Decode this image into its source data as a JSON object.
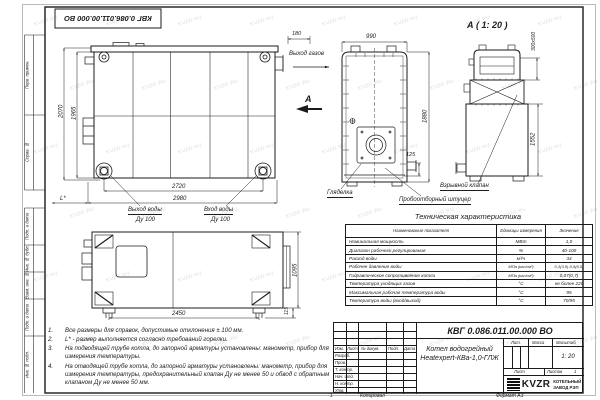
{
  "watermark": "KVZR.RU",
  "frame": {
    "stamp_top": "КВГ 0.086.011.00.000 ВО",
    "margin_labels": [
      "Перв. примен.",
      "Справ. №",
      "Подп. и дата",
      "Инв. № дубл.",
      "Взам. инв. №",
      "Подп. и дата",
      "Инв. № подл."
    ],
    "footer_sheet_num": "1",
    "footer_copy": "Копировал",
    "footer_format": "Формат А3"
  },
  "side_view": {
    "dim_h_outer": "2070",
    "dim_h_inner": "1965",
    "dim_w_inner": "2720",
    "dim_w_outer": "2980",
    "dim_l": "L*",
    "label_water_out": "Выход воды",
    "label_water_out_dn": "Ду 100",
    "label_water_in": "Вход воды",
    "label_water_in_dn": "Ду 100"
  },
  "front_view": {
    "dim_offset": "180",
    "dim_width": "990",
    "dim_height": "1880",
    "dim_pipe": "125",
    "label_gas_out": "Выход газов",
    "label_view": "А",
    "label_sight": "Гляделка",
    "label_sampler": "Пробоотборный штуцер"
  },
  "detail_view": {
    "title": "А ( 1: 20 )",
    "dim_valve": "300х500",
    "dim_height": "1552",
    "label_valve": "Взрывной клапан"
  },
  "top_view": {
    "dim_width": "2450",
    "dim_depth": "1095",
    "dim_foot": "115"
  },
  "notes": [
    {
      "num": "1.",
      "text": "Все размеры для справок, допустимые отклонения ± 100 мм."
    },
    {
      "num": "2.",
      "text": "L* - размер выполняется согласно требований горелки."
    },
    {
      "num": "3.",
      "text": "На подводящей трубе котла, до запорной арматуры установлены: манометр, прибор для измерения температуры."
    },
    {
      "num": "4.",
      "text": "На отводящей трубе котла, до запорной арматуры установлены: манометр, прибор для измерения температуры, предохранительный клапан Ду не менее 50 и обвод с обратным клапаном Ду не менее 50 мм."
    }
  ],
  "tech_table": {
    "title": "Техническая характеристика",
    "headers": {
      "name": "Наименование показателя",
      "units": "Единицы измерения",
      "value": "Значение"
    },
    "rows": [
      {
        "name": "Номинальная мощность",
        "units": "МВт",
        "value": "1,0"
      },
      {
        "name": "Диапазон рабочего регулирования",
        "units": "%",
        "value": "40-100"
      },
      {
        "name": "Расход воды",
        "units": "м³/ч",
        "value": "34"
      },
      {
        "name": "Рабочее давление воды",
        "units": "МПа (кгс/см²)",
        "value": "0,3(3,0)-0,6(6,0)"
      },
      {
        "name": "Гидравлическое сопротивление котла",
        "units": "МПа (кгс/см²)",
        "value": "0,07(0,7)"
      },
      {
        "name": "Температура уходящих газов",
        "units": "°С",
        "value": "не более 220"
      },
      {
        "name": "Максимальная рабочая температура воды",
        "units": "°С",
        "value": "95"
      },
      {
        "name": "Температура воды (вход/выход)",
        "units": "°С",
        "value": "70/95"
      }
    ]
  },
  "title_block": {
    "doc_number": "КВГ 0.086.011.00.000 ВО",
    "name_line1": "Котел водогрейный",
    "name_line2": "Heatexpert-КВа-1,0-ГЛЖ",
    "col_izm": "Изм.",
    "col_list": "Лист",
    "col_doc": "№ докум.",
    "col_podp": "Подп.",
    "col_data": "Дата",
    "roles": [
      "Разраб.",
      "Пров.",
      "Т. контр.",
      "Нач. отд.",
      "Н. контр.",
      "Утв."
    ],
    "lit_label": "Лит.",
    "mass_label": "Масса",
    "scale_label": "Масштаб",
    "scale_value": "1: 20",
    "sheet_label": "Лист",
    "sheets_label": "Листов",
    "sheets_value": "1",
    "logo_text": "KVZR",
    "company_line1": "КОТЕЛЬНЫЙ",
    "company_line2": "ЗАВОД РЭП"
  }
}
